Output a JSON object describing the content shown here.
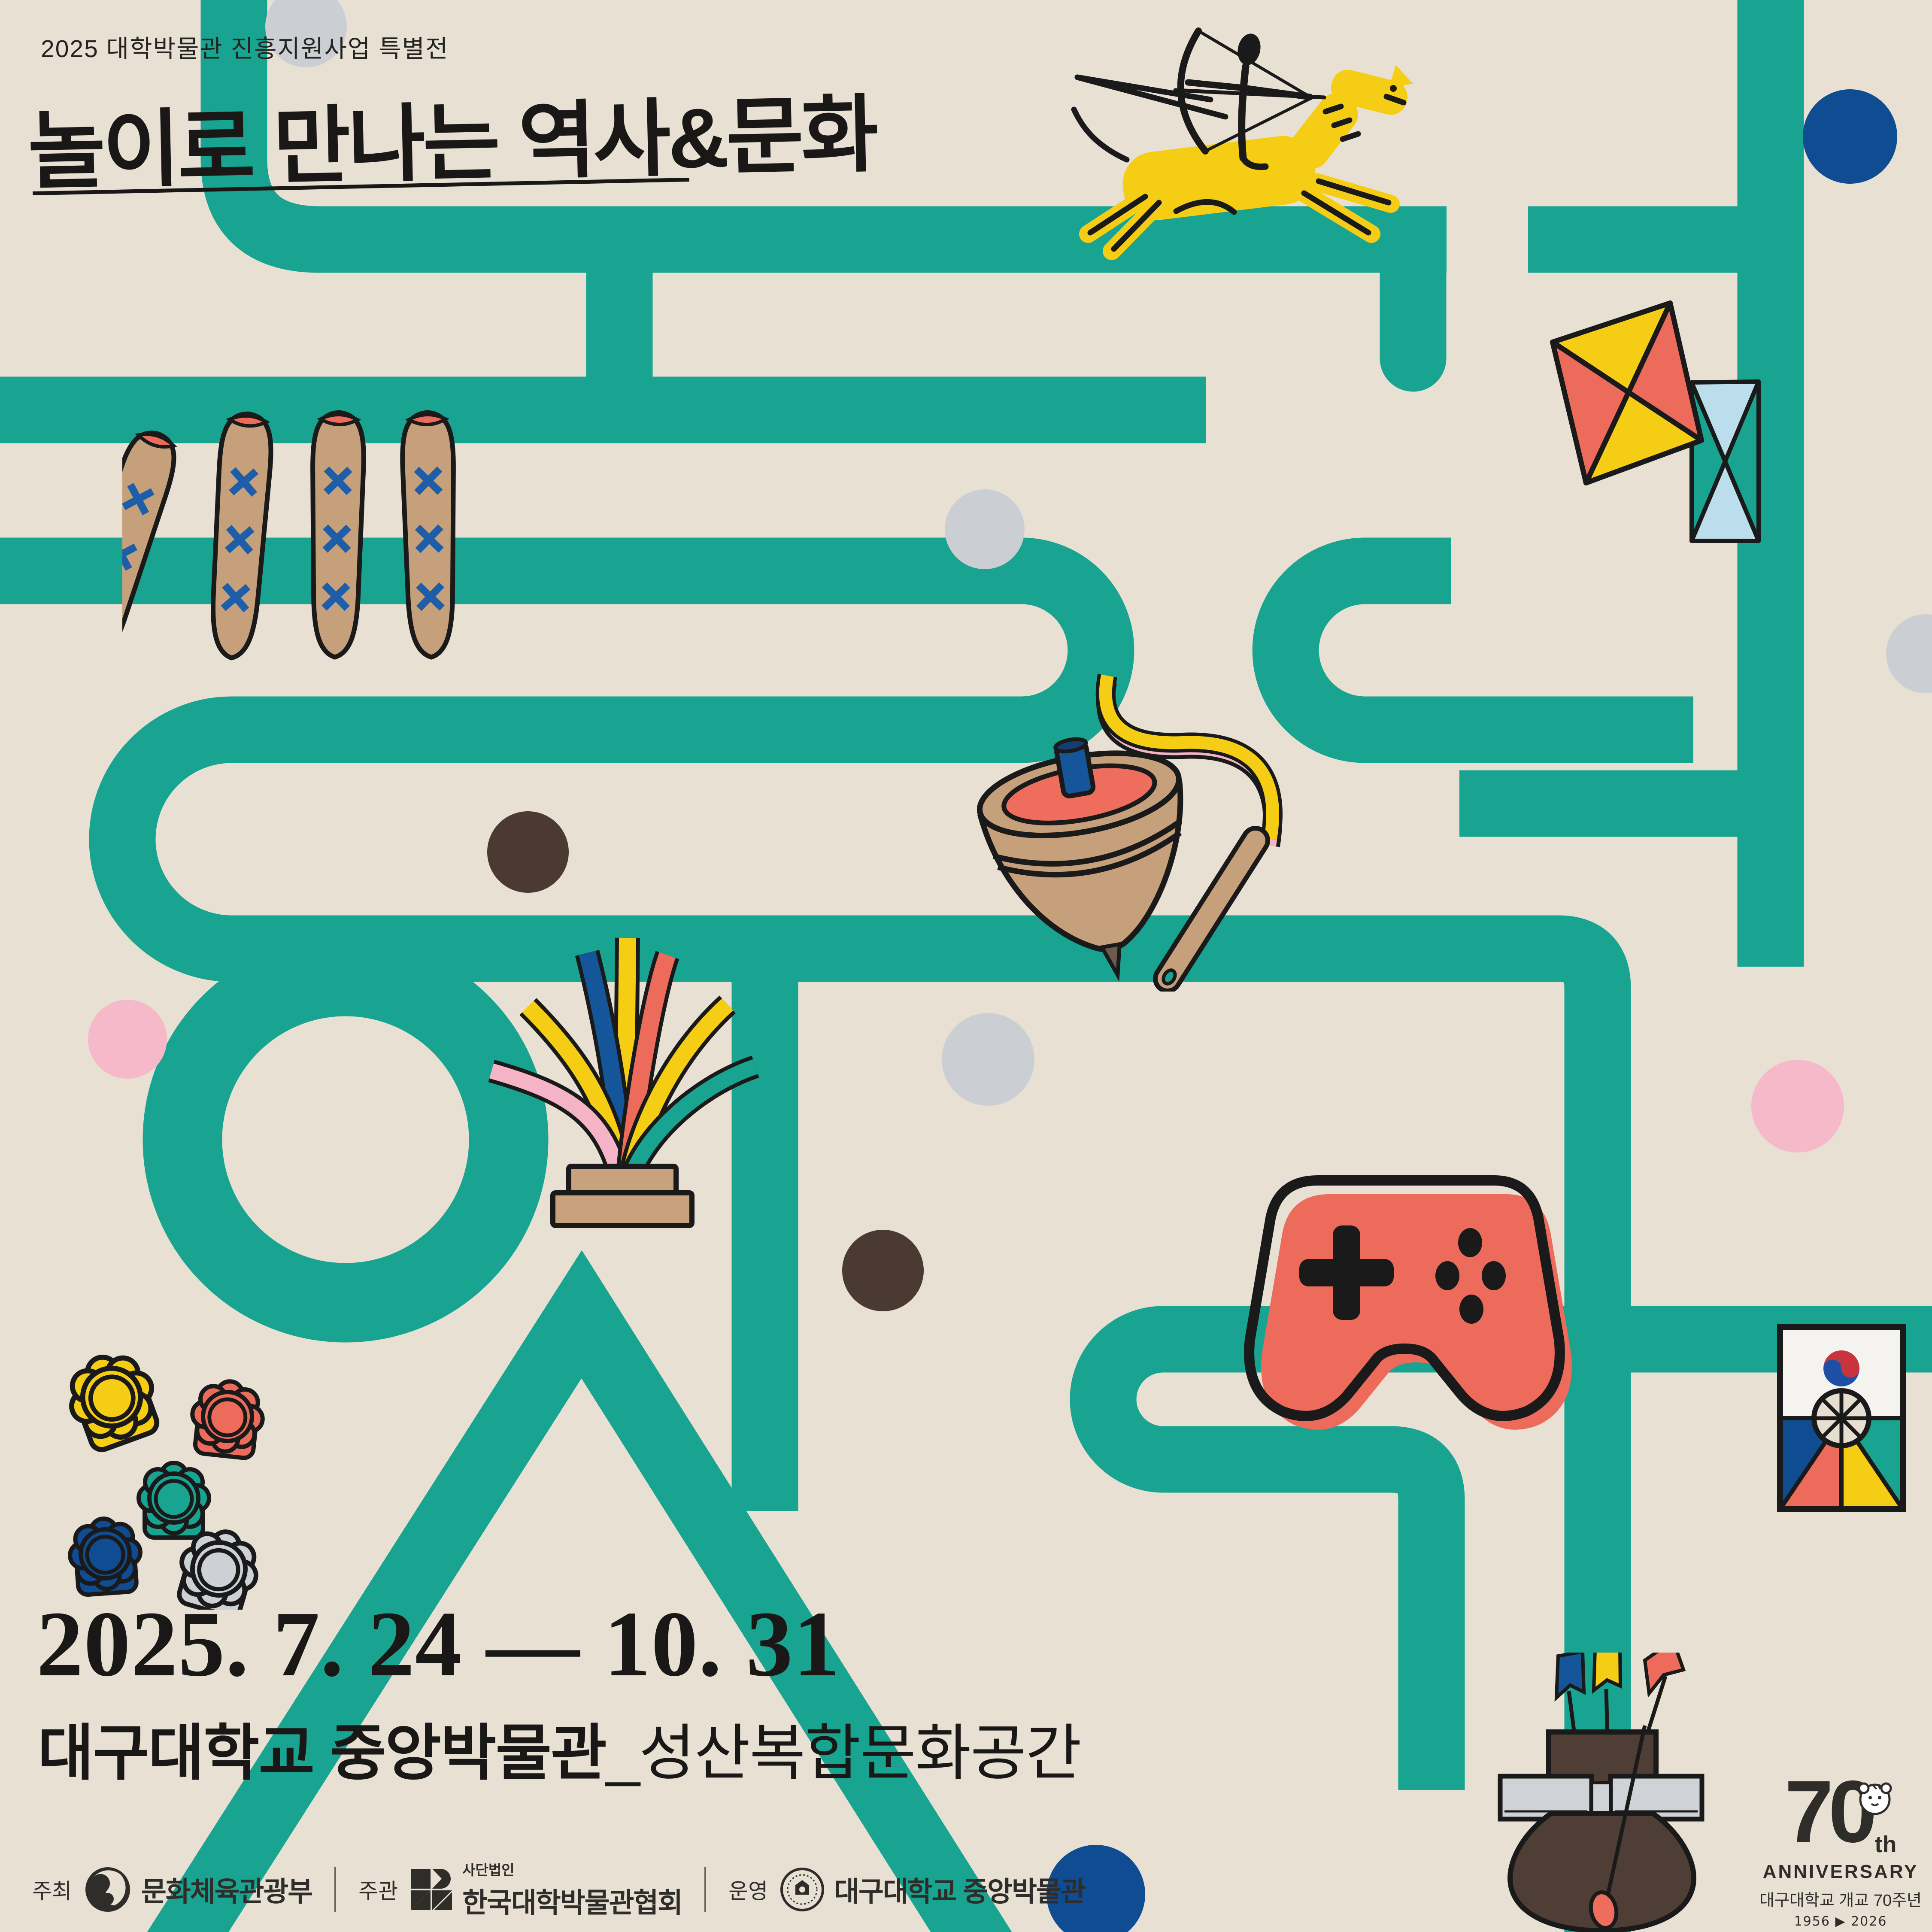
{
  "poster": {
    "edition": "2025 대학박물관 진흥지원사업 특별전",
    "title": "놀이로 만나는 역사&문화",
    "date_range": "2025. 7. 24 — 10. 31",
    "venue": "대구대학교 중앙박물관",
    "venue_sub": "_성산복합문화공간"
  },
  "footer": {
    "host_label": "주최",
    "host_name": "문화체육관광부",
    "organizer_label": "주관",
    "organizer_prefix": "사단법인",
    "organizer_name": "한국대학박물관협회",
    "operator_label": "운영",
    "operator_name": "대구대학교 중앙박물관"
  },
  "anniversary": {
    "number": "70",
    "suffix": "th",
    "word": "ANNIVERSARY",
    "caption": "대구대학교 개교 70주년",
    "years": "1956 ▶ 2026"
  },
  "icons": [
    "mounted-archer-on-horse",
    "twin-paper-kites",
    "yut-sticks",
    "spinning-top-and-whip",
    "jegi-shuttlecock",
    "game-controller",
    "flower-game-pieces",
    "korean-shield-kite",
    "tuho-arrow-pot",
    "taegeuk-ministry-logo",
    "museum-association-logo",
    "university-seal",
    "tiger-mascot"
  ],
  "palette": {
    "background": "#E8E1D3",
    "teal": "#18A491",
    "yellow": "#F6CD15",
    "coral": "#ED6B5B",
    "blue": "#15559A",
    "deep_blue": "#0F4C92",
    "pink": "#F4B3C6",
    "light_blue": "#BCDDEB",
    "tan": "#C6A07B",
    "brown": "#4A3A32",
    "silver": "#CDD1D5",
    "ink": "#1A1A1A"
  }
}
